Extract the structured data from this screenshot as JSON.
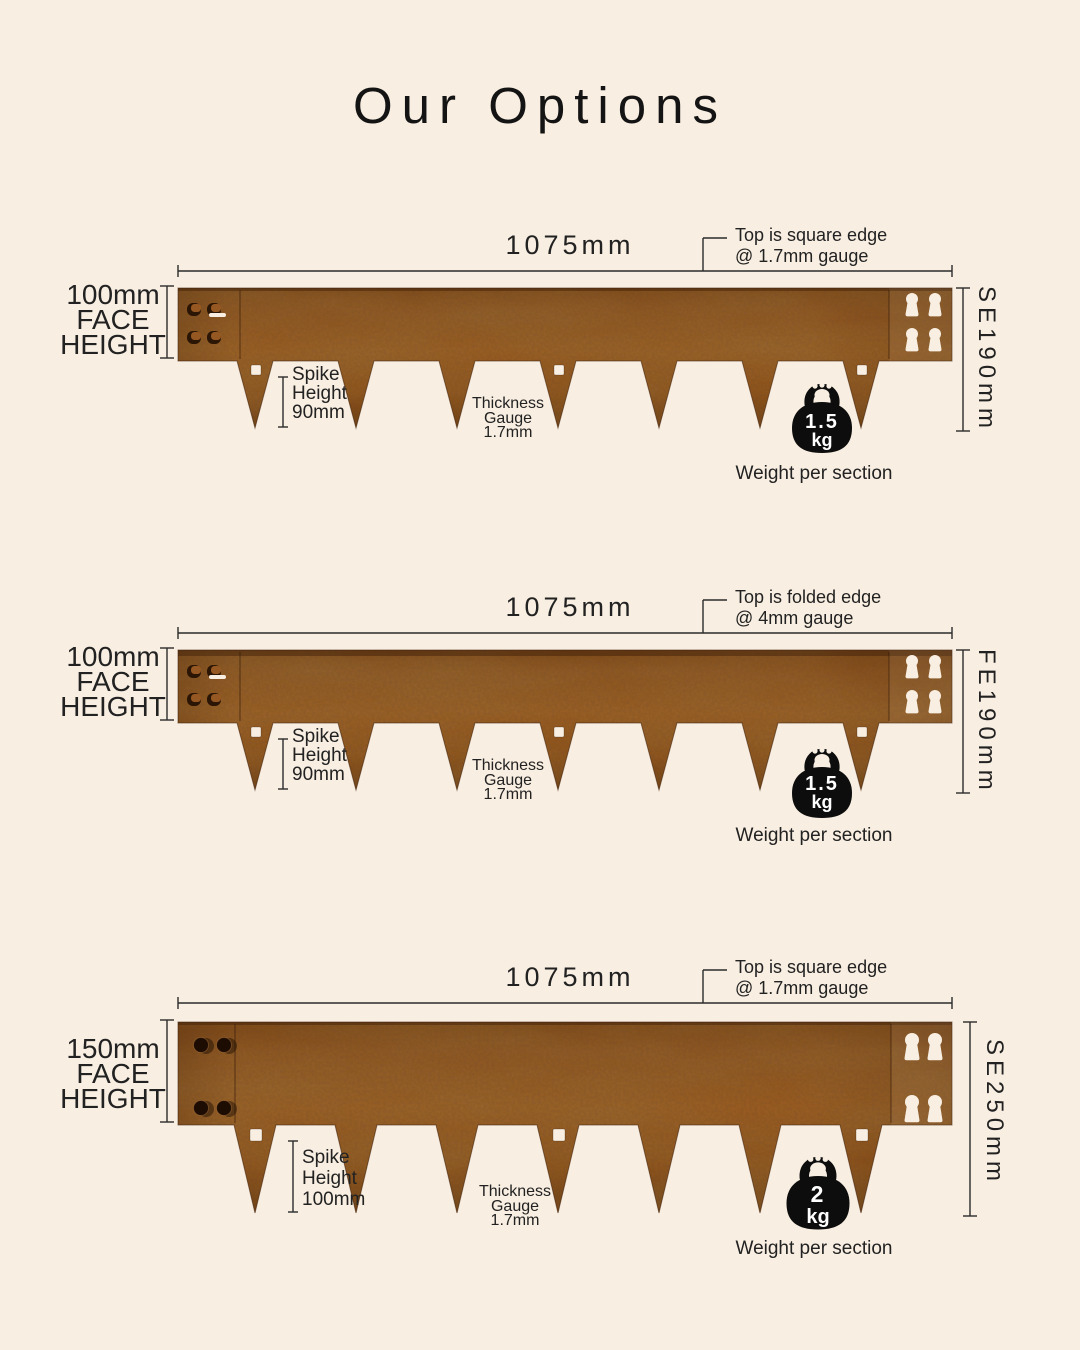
{
  "title": "Our Options",
  "colors": {
    "background": "#f8eee1",
    "ink": "#2b2b2b",
    "rust_top": "#7a4316",
    "rust_mid": "#9c5c24",
    "rust_low": "#8f4f1a",
    "rust_bottom": "#66350f",
    "cutout": "#f8eee1",
    "icon_black": "#0d0d0d"
  },
  "sections": [
    {
      "code": "SE190mm",
      "length": "1075mm",
      "callout": {
        "line1": "Top is square edge",
        "line2": "@ 1.7mm gauge"
      },
      "face_height": {
        "line1": "100mm",
        "line2": "FACE",
        "line3": "HEIGHT"
      },
      "spike": {
        "line1": "Spike",
        "line2": "Height",
        "line3": "90mm"
      },
      "thickness": {
        "line1": "Thickness",
        "line2": "Gauge",
        "line3": "1.7mm"
      },
      "weight": {
        "value": "1.5",
        "unit": "kg",
        "caption": "Weight per section"
      }
    },
    {
      "code": "FE190mm",
      "length": "1075mm",
      "callout": {
        "line1": "Top is folded edge",
        "line2": "@ 4mm gauge"
      },
      "face_height": {
        "line1": "100mm",
        "line2": "FACE",
        "line3": "HEIGHT"
      },
      "spike": {
        "line1": "Spike",
        "line2": "Height",
        "line3": "90mm"
      },
      "thickness": {
        "line1": "Thickness",
        "line2": "Gauge",
        "line3": "1.7mm"
      },
      "weight": {
        "value": "1.5",
        "unit": "kg",
        "caption": "Weight per section"
      }
    },
    {
      "code": "SE250mm",
      "length": "1075mm",
      "callout": {
        "line1": "Top is square edge",
        "line2": "@ 1.7mm gauge"
      },
      "face_height": {
        "line1": "150mm",
        "line2": "FACE",
        "line3": "HEIGHT"
      },
      "spike": {
        "line1": "Spike",
        "line2": "Height",
        "line3": "100mm"
      },
      "thickness": {
        "line1": "Thickness",
        "line2": "Gauge",
        "line3": "1.7mm"
      },
      "weight": {
        "value": "2",
        "unit": "kg",
        "caption": "Weight per section"
      }
    }
  ]
}
